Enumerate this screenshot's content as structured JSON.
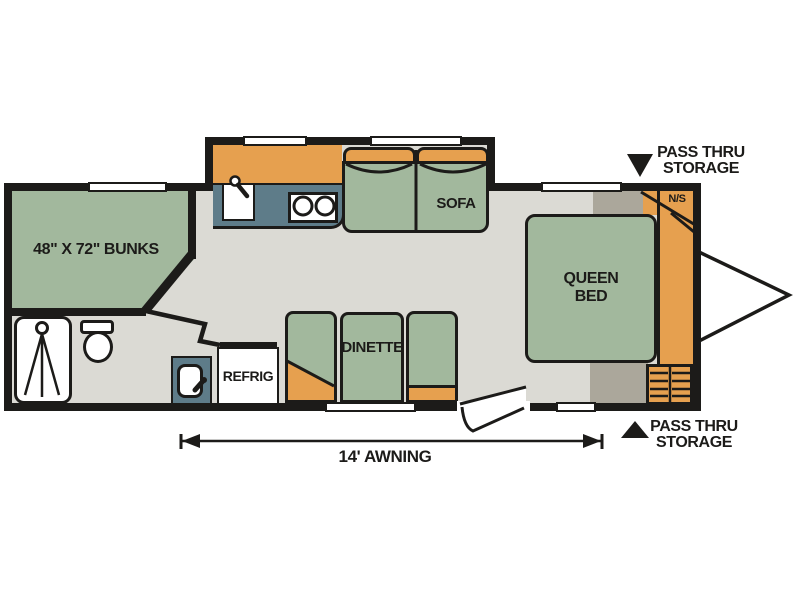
{
  "diagram": {
    "title": "travel trailer floor plan",
    "rooms": {
      "bunks": {
        "label": "48\" X 72\" BUNKS"
      },
      "sofa": {
        "label": "SOFA"
      },
      "dinette": {
        "label": "DINETTE"
      },
      "refrigerator": {
        "label": "REFRIG"
      },
      "queen_bed": {
        "line1": "QUEEN",
        "line2": "BED"
      },
      "nightstand": {
        "label": "N/S"
      }
    },
    "callouts": {
      "pass_thru_top": {
        "line1": "PASS THRU",
        "line2": "STORAGE"
      },
      "pass_thru_bottom": {
        "line1": "PASS THRU",
        "line2": "STORAGE"
      },
      "awning": {
        "label": "14' AWNING"
      }
    },
    "fixtures": [
      "shower-stall",
      "toilet",
      "bathroom-sink",
      "kitchen-sink",
      "two-burner-stove",
      "sofa",
      "dinette",
      "refrigerator",
      "queen-bed",
      "bunk-beds",
      "wardrobe",
      "nightstand",
      "entry-steps",
      "entry-door",
      "trailer-tongue",
      "slide-out"
    ],
    "colors": {
      "furniture_green": "#A2B89D",
      "cabinet_orange": "#E6A04F",
      "counter_teal": "#5E7C89",
      "floor_gray": "#DBDAD4",
      "shadow_gray": "#ABA79B",
      "wall_black": "#1C1B19",
      "background": "#FFFFFF"
    }
  }
}
